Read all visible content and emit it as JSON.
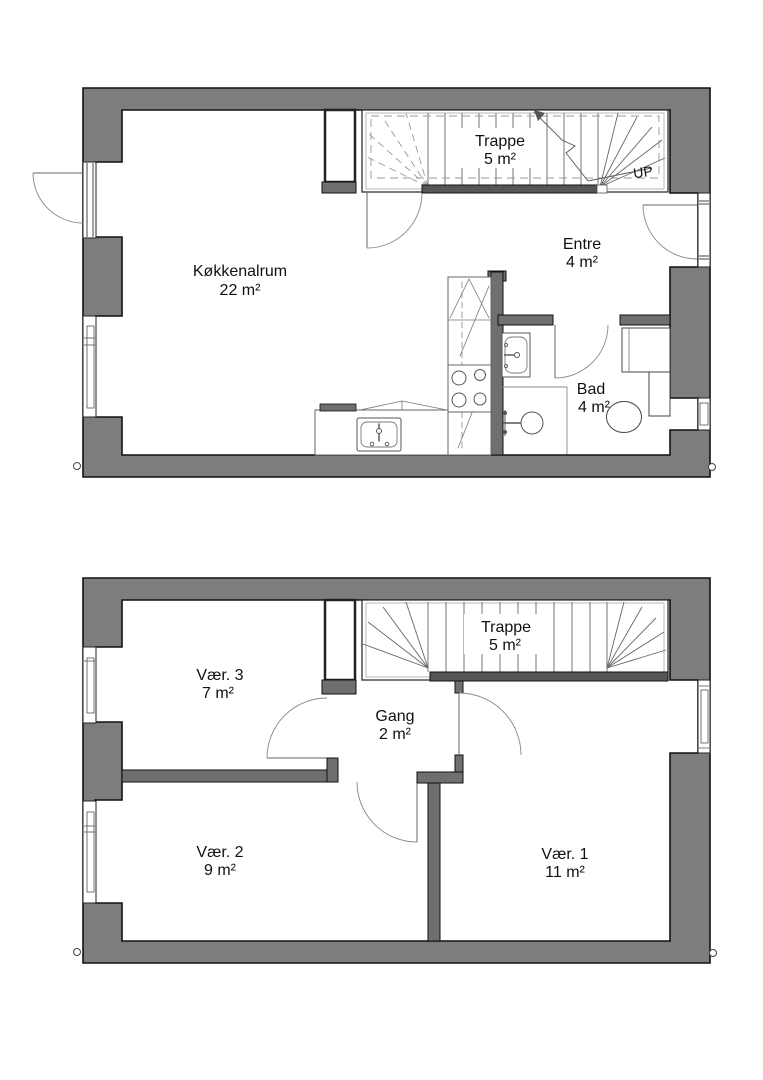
{
  "floors": [
    {
      "name": "upper-floor",
      "stair_up_label": "UP",
      "rooms": [
        {
          "label": "Trappe",
          "area": "5 m²"
        },
        {
          "label": "Entre",
          "area": "4 m²"
        },
        {
          "label": "Køkkenalrum",
          "area": "22 m²"
        },
        {
          "label": "Bad",
          "area": "4 m²"
        }
      ],
      "fixtures": [
        "stairs",
        "kitchen-counter",
        "kitchen-sink",
        "stove",
        "refrigerator",
        "bathroom-sink",
        "shower",
        "toilet",
        "cabinet"
      ]
    },
    {
      "name": "lower-floor",
      "rooms": [
        {
          "label": "Trappe",
          "area": "5 m²"
        },
        {
          "label": "Vær. 3",
          "area": "7 m²"
        },
        {
          "label": "Gang",
          "area": "2 m²"
        },
        {
          "label": "Vær. 2",
          "area": "9 m²"
        },
        {
          "label": "Vær. 1",
          "area": "11 m²"
        }
      ],
      "fixtures": [
        "stairs"
      ]
    }
  ],
  "colors": {
    "exterior_wall": "#7d7d7d",
    "interior_wall": "#6f6f6f",
    "stair_wall": "#565656",
    "line": "#111111",
    "background": "#ffffff"
  }
}
